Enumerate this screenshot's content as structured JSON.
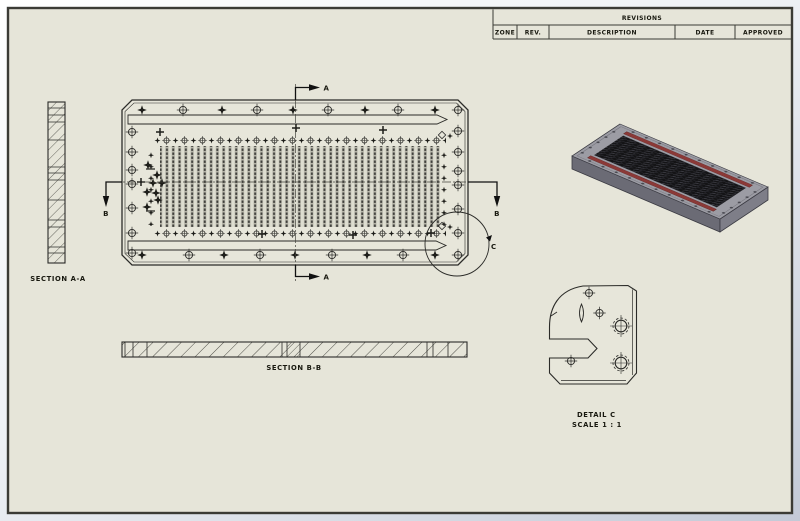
{
  "revisions_table": {
    "title": "REVISIONS",
    "columns": [
      "ZONE",
      "REV.",
      "DESCRIPTION",
      "DATE",
      "APPROVED"
    ]
  },
  "labels": {
    "section_aa": "SECTION A-A",
    "section_bb": "SECTION B-B",
    "detail_c": "DETAIL C",
    "detail_c_scale": "SCALE 1 : 1",
    "mark_a": "A",
    "mark_b": "B",
    "mark_c": "C"
  },
  "colors": {
    "paper": "#e6e5d9",
    "line": "#2b2b28",
    "sheet_border": "#3b3b35",
    "viewport_top": "#ffffff",
    "viewport_bottom": "#c3cad7",
    "iso_top_face": "#9c9ca4",
    "iso_side_face": "#7e7e88",
    "iso_side_face_dark": "#6b6b75",
    "iso_slot_red": "#8b3937",
    "iso_center_black": "#141416"
  }
}
